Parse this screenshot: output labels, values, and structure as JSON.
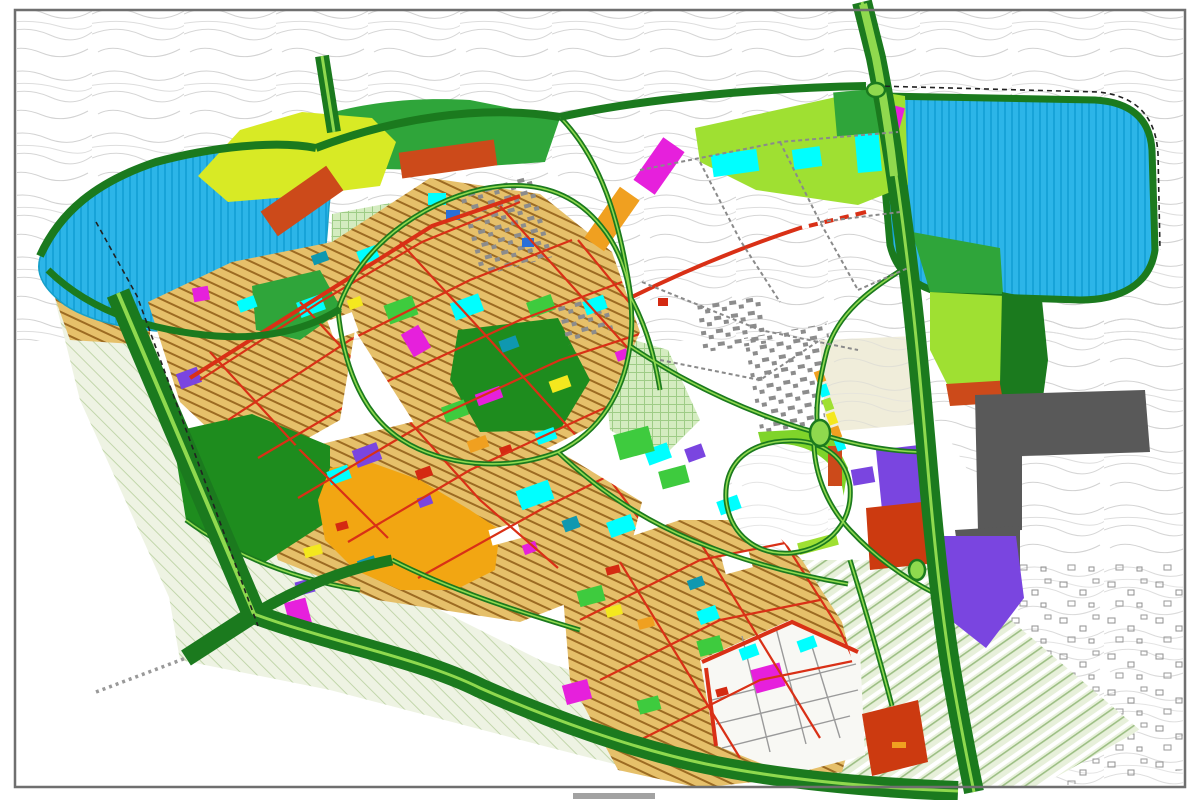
{
  "map": {
    "kind": "urban-master-plan-zoning-map",
    "frame_color": "#6f6f6f",
    "page_bg": "#ffffff",
    "caption_fragment_color": "#555555"
  },
  "palette": {
    "water": "#2cb5e8",
    "water_hatch": "#17a3d8",
    "road_major": "#1b7a1e",
    "road_median": "#8fd94e",
    "road_red": "#d93016",
    "red_parcel": "#d42a12",
    "park_dark": "#1e8c1e",
    "green_mid": "#2fa53a",
    "green_bright": "#3ecb3e",
    "lime": "#9fe032",
    "lime_bright": "#7fd42a",
    "yellow_green": "#d8ea25",
    "yellow": "#f4e81e",
    "residential_tan": "#e6c06a",
    "residential_line": "#9c6b22",
    "amber": "#f2a612",
    "orange": "#f0a020",
    "magenta": "#e620dc",
    "purple": "#7a45e0",
    "terracotta": "#cc4a1a",
    "red_zone": "#cc3a10",
    "dark_gray": "#595959",
    "building_gray": "#8c8c8c",
    "pale_park": "#d4ecc0",
    "pale_park_line": "#9ecc86",
    "sage": "#eef3e3",
    "sage_line": "#c2d6ab",
    "agri": "#e7f0da",
    "agri_line": "#9dbf85",
    "beige": "#f3ead0",
    "beige_line": "#cdb888",
    "contour": "#d2d2d2",
    "village_line": "#909090",
    "white_parcel": "#ffffff",
    "teal": "#0f98b0",
    "blue": "#2a6fd8",
    "dashed_gray": "#999999",
    "boundary_black": "#222222"
  },
  "legend": [
    {
      "zone": "water-body",
      "color_key": "water"
    },
    {
      "zone": "green-arterial-road",
      "color_key": "road_major"
    },
    {
      "zone": "road-median-strip",
      "color_key": "road_median"
    },
    {
      "zone": "red-collector-road",
      "color_key": "road_red"
    },
    {
      "zone": "dense-residential-fabric",
      "color_key": "residential_tan"
    },
    {
      "zone": "city-center-commercial",
      "color_key": "amber"
    },
    {
      "zone": "parkland",
      "color_key": "park_dark"
    },
    {
      "zone": "green-space",
      "color_key": "green_mid"
    },
    {
      "zone": "proposed-development",
      "color_key": "lime"
    },
    {
      "zone": "special-use-magenta",
      "color_key": "magenta"
    },
    {
      "zone": "special-use-purple",
      "color_key": "purple"
    },
    {
      "zone": "industrial-gray",
      "color_key": "dark_gray"
    },
    {
      "zone": "agricultural-strips",
      "color_key": "agri"
    },
    {
      "zone": "existing-village",
      "color_key": "village_line"
    }
  ],
  "roads": {
    "major": [
      {
        "d": "M118,293 L254,614",
        "w": 24,
        "m": 4
      },
      {
        "d": "M254,614 L186,658",
        "w": 18,
        "m": 0
      },
      {
        "d": "M254,614 C330,642 420,658 480,688 C548,718 630,748 706,764 C790,781 880,788 958,791",
        "w": 20,
        "m": 3
      },
      {
        "d": "M254,614 C298,588 342,570 392,560",
        "w": 11,
        "m": 0
      },
      {
        "d": "M862,2 L876,58 C890,128 900,198 908,266 C916,330 922,400 928,470 C934,540 941,608 951,670 C959,718 967,758 974,792",
        "w": 20,
        "m": 3
      },
      {
        "d": "M40,256 C60,212 96,182 156,162 C212,147 276,140 316,148",
        "w": 8,
        "m": 0
      },
      {
        "d": "M316,148 C392,119 480,104 560,117",
        "w": 8,
        "m": 0
      },
      {
        "d": "M560,117 C642,99 760,88 866,86",
        "w": 8,
        "m": 0
      },
      {
        "d": "M322,56 L334,132",
        "w": 14,
        "m": 3
      },
      {
        "d": "M48,270 C92,313 152,331 216,336 C270,340 312,327 340,309",
        "w": 7,
        "m": 0
      },
      {
        "d": "M863,4 L876,58 C884,100 890,140 894,176",
        "w": 0,
        "m": 8
      }
    ],
    "minor": [
      "M338,310 C358,248 420,203 482,189 C532,179 572,190 601,226 C626,256 636,300 630,346 C624,392 600,432 558,452 C506,472 442,466 402,440 C366,417 344,372 338,310 Z",
      "M560,117 C600,158 620,218 631,298",
      "M631,298 C648,330 655,360 660,390",
      "M630,346 C690,386 752,414 814,432",
      "M814,432 C858,447 898,452 926,452",
      "M814,432 C812,470 826,504 850,530 C878,560 908,580 936,594",
      "M908,266 C868,290 838,314 827,350 C818,385 815,410 818,432",
      "M558,452 C600,492 644,520 692,540 C740,560 790,574 848,584",
      "M850,560 C868,618 880,660 892,706",
      "M726,500 C724,470 740,448 775,442 C815,436 845,452 850,486 C853,520 832,548 792,553 C756,556 730,534 726,500 Z",
      "M186,520 C240,560 300,580 360,590",
      "M392,560 C450,590 520,612 580,630"
    ],
    "red_major": [
      "M190,378 L330,290 L432,226 L520,196",
      "M630,298 C690,268 746,246 800,228 L866,212",
      "M702,662 L792,622 L858,652",
      "M706,668 L716,746"
    ],
    "red_grid": [
      "M200,380 L320,302 L422,242 L520,202",
      "M228,420 L350,340 L470,280 L572,240",
      "M258,458 L390,380 L520,320 L622,282",
      "M298,498 L430,420 L560,360 L652,330",
      "M348,542 L470,470 L600,410 L682,380",
      "M418,578 L540,510 L660,450 L742,420",
      "M210,352 L300,450 L388,538",
      "M300,302 L390,400 L480,500 L558,568",
      "M400,242 L490,340 L580,440 L640,520",
      "M500,206 L590,306 L680,406 L722,470",
      "M578,240 L660,340 L740,440",
      "M580,620 L700,560 L800,540",
      "M600,680 L720,620 L820,600",
      "M640,740 L760,680 L858,660",
      "M620,562 L680,660 L740,758",
      "M700,542 L760,640 L820,738",
      "M778,532 L840,630 L880,718"
    ],
    "dashed_gray": [
      "M96,692 L186,658"
    ],
    "district_dashed": [
      "M640,170 L780,142 L898,132",
      "M700,162 L740,240 L780,302",
      "M780,142 L820,222 L858,290",
      "M642,282 L760,330 L858,350",
      "M820,222 L900,212",
      "M660,360 L760,380 L820,340",
      "M858,290 L908,268"
    ],
    "dashed_black": [
      "M96,222 L137,296 L258,626",
      "M876,86 L1098,92 C1138,96 1156,118 1158,154 L1160,250"
    ],
    "white_dash_on_red": [
      "M802,227 L864,212"
    ],
    "village_grid_gray": [
      "M712,700 L856,664",
      "M716,724 L858,690",
      "M722,748 L850,716",
      "M742,636 L770,752",
      "M776,628 L806,744",
      "M810,640 L840,738"
    ]
  },
  "roundabouts": [
    {
      "cx": 820,
      "cy": 433,
      "rx": 10,
      "ry": 13
    },
    {
      "cx": 917,
      "cy": 570,
      "rx": 8,
      "ry": 10
    },
    {
      "cx": 876,
      "cy": 90,
      "rx": 9,
      "ry": 7
    }
  ],
  "gray_block_clusters": [
    {
      "x": 468,
      "y": 180,
      "w": 76,
      "h": 88,
      "r": -15
    },
    {
      "x": 700,
      "y": 298,
      "w": 64,
      "h": 50,
      "r": -8
    },
    {
      "x": 752,
      "y": 330,
      "w": 84,
      "h": 100,
      "r": -10
    },
    {
      "x": 560,
      "y": 300,
      "w": 50,
      "h": 40,
      "r": -15
    }
  ],
  "parcels": [
    {
      "x": 298,
      "y": 298,
      "w": 26,
      "h": 16,
      "r": -20,
      "c": "cyan"
    },
    {
      "x": 358,
      "y": 248,
      "w": 20,
      "h": 14,
      "r": -20,
      "c": "cyan"
    },
    {
      "x": 452,
      "y": 298,
      "w": 30,
      "h": 18,
      "r": -20,
      "c": "cyan"
    },
    {
      "x": 428,
      "y": 193,
      "w": 18,
      "h": 12,
      "r": 0,
      "c": "cyan"
    },
    {
      "x": 518,
      "y": 485,
      "w": 34,
      "h": 20,
      "r": -20,
      "c": "cyan"
    },
    {
      "x": 608,
      "y": 518,
      "w": 26,
      "h": 16,
      "r": -20,
      "c": "cyan"
    },
    {
      "x": 646,
      "y": 446,
      "w": 24,
      "h": 16,
      "r": -20,
      "c": "cyan"
    },
    {
      "x": 698,
      "y": 608,
      "w": 20,
      "h": 14,
      "r": -20,
      "c": "cyan"
    },
    {
      "x": 740,
      "y": 646,
      "w": 18,
      "h": 12,
      "r": -20,
      "c": "cyan"
    },
    {
      "x": 536,
      "y": 430,
      "w": 20,
      "h": 12,
      "r": -20,
      "c": "cyan"
    },
    {
      "x": 584,
      "y": 298,
      "w": 22,
      "h": 14,
      "r": -20,
      "c": "cyan"
    },
    {
      "x": 238,
      "y": 298,
      "w": 18,
      "h": 12,
      "r": -20,
      "c": "cyan"
    },
    {
      "x": 328,
      "y": 468,
      "w": 22,
      "h": 14,
      "r": -20,
      "c": "cyan"
    },
    {
      "x": 718,
      "y": 498,
      "w": 22,
      "h": 14,
      "r": -20,
      "c": "cyan"
    },
    {
      "x": 798,
      "y": 638,
      "w": 18,
      "h": 12,
      "r": -20,
      "c": "cyan"
    },
    {
      "x": 712,
      "y": 152,
      "w": 46,
      "h": 22,
      "r": -8,
      "c": "cyan"
    },
    {
      "x": 793,
      "y": 148,
      "w": 28,
      "h": 20,
      "r": -8,
      "c": "cyan"
    },
    {
      "x": 856,
      "y": 128,
      "w": 24,
      "h": 44,
      "r": -5,
      "c": "cyan"
    },
    {
      "x": 312,
      "y": 253,
      "w": 16,
      "h": 10,
      "r": -20,
      "c": "teal"
    },
    {
      "x": 500,
      "y": 338,
      "w": 18,
      "h": 12,
      "r": -20,
      "c": "teal"
    },
    {
      "x": 563,
      "y": 518,
      "w": 16,
      "h": 12,
      "r": -20,
      "c": "teal"
    },
    {
      "x": 688,
      "y": 578,
      "w": 16,
      "h": 10,
      "r": -20,
      "c": "teal"
    },
    {
      "x": 358,
      "y": 558,
      "w": 18,
      "h": 10,
      "r": -20,
      "c": "teal"
    },
    {
      "x": 446,
      "y": 210,
      "w": 14,
      "h": 10,
      "r": 0,
      "c": "blue"
    },
    {
      "x": 522,
      "y": 238,
      "w": 12,
      "h": 9,
      "r": 0,
      "c": "blue"
    },
    {
      "x": 406,
      "y": 328,
      "w": 20,
      "h": 26,
      "r": -30,
      "c": "magenta"
    },
    {
      "x": 476,
      "y": 390,
      "w": 26,
      "h": 12,
      "r": -20,
      "c": "magenta"
    },
    {
      "x": 287,
      "y": 600,
      "w": 22,
      "h": 26,
      "r": -15,
      "c": "magenta"
    },
    {
      "x": 564,
      "y": 682,
      "w": 26,
      "h": 20,
      "r": -15,
      "c": "magenta"
    },
    {
      "x": 753,
      "y": 666,
      "w": 30,
      "h": 24,
      "r": -15,
      "c": "magenta"
    },
    {
      "x": 523,
      "y": 543,
      "w": 14,
      "h": 10,
      "r": -20,
      "c": "magenta"
    },
    {
      "x": 616,
      "y": 350,
      "w": 12,
      "h": 10,
      "r": -20,
      "c": "magenta"
    },
    {
      "x": 888,
      "y": 106,
      "w": 14,
      "h": 24,
      "r": 15,
      "c": "magenta"
    },
    {
      "x": 646,
      "y": 140,
      "w": 26,
      "h": 52,
      "r": 35,
      "c": "magenta"
    },
    {
      "x": 193,
      "y": 287,
      "w": 16,
      "h": 14,
      "r": -10,
      "c": "magenta"
    },
    {
      "x": 178,
      "y": 370,
      "w": 22,
      "h": 16,
      "r": -20,
      "c": "purple"
    },
    {
      "x": 296,
      "y": 580,
      "w": 18,
      "h": 14,
      "r": -15,
      "c": "purple"
    },
    {
      "x": 686,
      "y": 446,
      "w": 18,
      "h": 14,
      "r": -20,
      "c": "purple"
    },
    {
      "x": 418,
      "y": 496,
      "w": 14,
      "h": 10,
      "r": -20,
      "c": "purple"
    },
    {
      "x": 354,
      "y": 446,
      "w": 26,
      "h": 18,
      "r": -20,
      "c": "purple"
    },
    {
      "x": 852,
      "y": 468,
      "w": 22,
      "h": 16,
      "r": -10,
      "c": "purple"
    },
    {
      "x": 550,
      "y": 378,
      "w": 20,
      "h": 12,
      "r": -20,
      "c": "yellow"
    },
    {
      "x": 304,
      "y": 546,
      "w": 18,
      "h": 10,
      "r": -15,
      "c": "yellow"
    },
    {
      "x": 606,
      "y": 606,
      "w": 16,
      "h": 10,
      "r": -15,
      "c": "yellow"
    },
    {
      "x": 348,
      "y": 298,
      "w": 14,
      "h": 10,
      "r": -20,
      "c": "yellow"
    },
    {
      "x": 416,
      "y": 468,
      "w": 16,
      "h": 10,
      "r": -20,
      "c": "red_parcel"
    },
    {
      "x": 500,
      "y": 446,
      "w": 12,
      "h": 8,
      "r": -20,
      "c": "red_parcel"
    },
    {
      "x": 336,
      "y": 522,
      "w": 12,
      "h": 8,
      "r": -15,
      "c": "red_parcel"
    },
    {
      "x": 606,
      "y": 566,
      "w": 14,
      "h": 8,
      "r": -15,
      "c": "red_parcel"
    },
    {
      "x": 658,
      "y": 298,
      "w": 10,
      "h": 8,
      "r": 0,
      "c": "red_parcel"
    },
    {
      "x": 716,
      "y": 688,
      "w": 12,
      "h": 8,
      "r": -15,
      "c": "red_parcel"
    },
    {
      "x": 262,
      "y": 186,
      "w": 80,
      "h": 30,
      "r": -35,
      "c": "terracotta"
    },
    {
      "x": 400,
      "y": 146,
      "w": 96,
      "h": 26,
      "r": -8,
      "c": "terracotta"
    },
    {
      "x": 828,
      "y": 446,
      "w": 14,
      "h": 40,
      "r": 0,
      "c": "terracotta"
    },
    {
      "x": 386,
      "y": 300,
      "w": 30,
      "h": 20,
      "r": -20,
      "c": "green_bright"
    },
    {
      "x": 616,
      "y": 430,
      "w": 36,
      "h": 26,
      "r": -15,
      "c": "green_bright"
    },
    {
      "x": 660,
      "y": 468,
      "w": 28,
      "h": 18,
      "r": -15,
      "c": "green_bright"
    },
    {
      "x": 443,
      "y": 403,
      "w": 24,
      "h": 16,
      "r": -20,
      "c": "green_bright"
    },
    {
      "x": 528,
      "y": 298,
      "w": 26,
      "h": 16,
      "r": -20,
      "c": "green_bright"
    },
    {
      "x": 698,
      "y": 638,
      "w": 24,
      "h": 16,
      "r": -15,
      "c": "green_bright"
    },
    {
      "x": 638,
      "y": 698,
      "w": 22,
      "h": 14,
      "r": -15,
      "c": "green_bright"
    },
    {
      "x": 578,
      "y": 588,
      "w": 26,
      "h": 16,
      "r": -15,
      "c": "green_bright"
    },
    {
      "x": 835,
      "y": 90,
      "w": 56,
      "h": 44,
      "r": -5,
      "c": "green_mid"
    },
    {
      "x": 330,
      "y": 316,
      "w": 26,
      "h": 20,
      "r": -20,
      "c": "white_parcel"
    },
    {
      "x": 490,
      "y": 526,
      "w": 30,
      "h": 16,
      "r": -15,
      "c": "white_parcel"
    },
    {
      "x": 723,
      "y": 553,
      "w": 28,
      "h": 18,
      "r": -15,
      "c": "white_parcel"
    },
    {
      "x": 468,
      "y": 438,
      "w": 20,
      "h": 12,
      "r": -20,
      "c": "orange"
    },
    {
      "x": 638,
      "y": 618,
      "w": 16,
      "h": 10,
      "r": -15,
      "c": "orange"
    },
    {
      "x": 600,
      "y": 188,
      "w": 24,
      "h": 62,
      "r": 35,
      "c": "orange"
    },
    {
      "x": 798,
      "y": 538,
      "w": 40,
      "h": 12,
      "r": -15,
      "c": "lime"
    },
    {
      "x": 814,
      "y": 372,
      "w": 12,
      "h": 9,
      "r": 70,
      "c": "orange"
    },
    {
      "x": 818,
      "y": 386,
      "w": 12,
      "h": 9,
      "r": 70,
      "c": "cyan"
    },
    {
      "x": 822,
      "y": 400,
      "w": 12,
      "h": 9,
      "r": 70,
      "c": "lime"
    },
    {
      "x": 826,
      "y": 414,
      "w": 12,
      "h": 9,
      "r": 70,
      "c": "yellow"
    },
    {
      "x": 830,
      "y": 428,
      "w": 12,
      "h": 9,
      "r": 70,
      "c": "orange"
    },
    {
      "x": 834,
      "y": 440,
      "w": 12,
      "h": 9,
      "r": 70,
      "c": "cyan"
    },
    {
      "x": 892,
      "y": 742,
      "w": 14,
      "h": 6,
      "r": 0,
      "c": "orange"
    }
  ]
}
